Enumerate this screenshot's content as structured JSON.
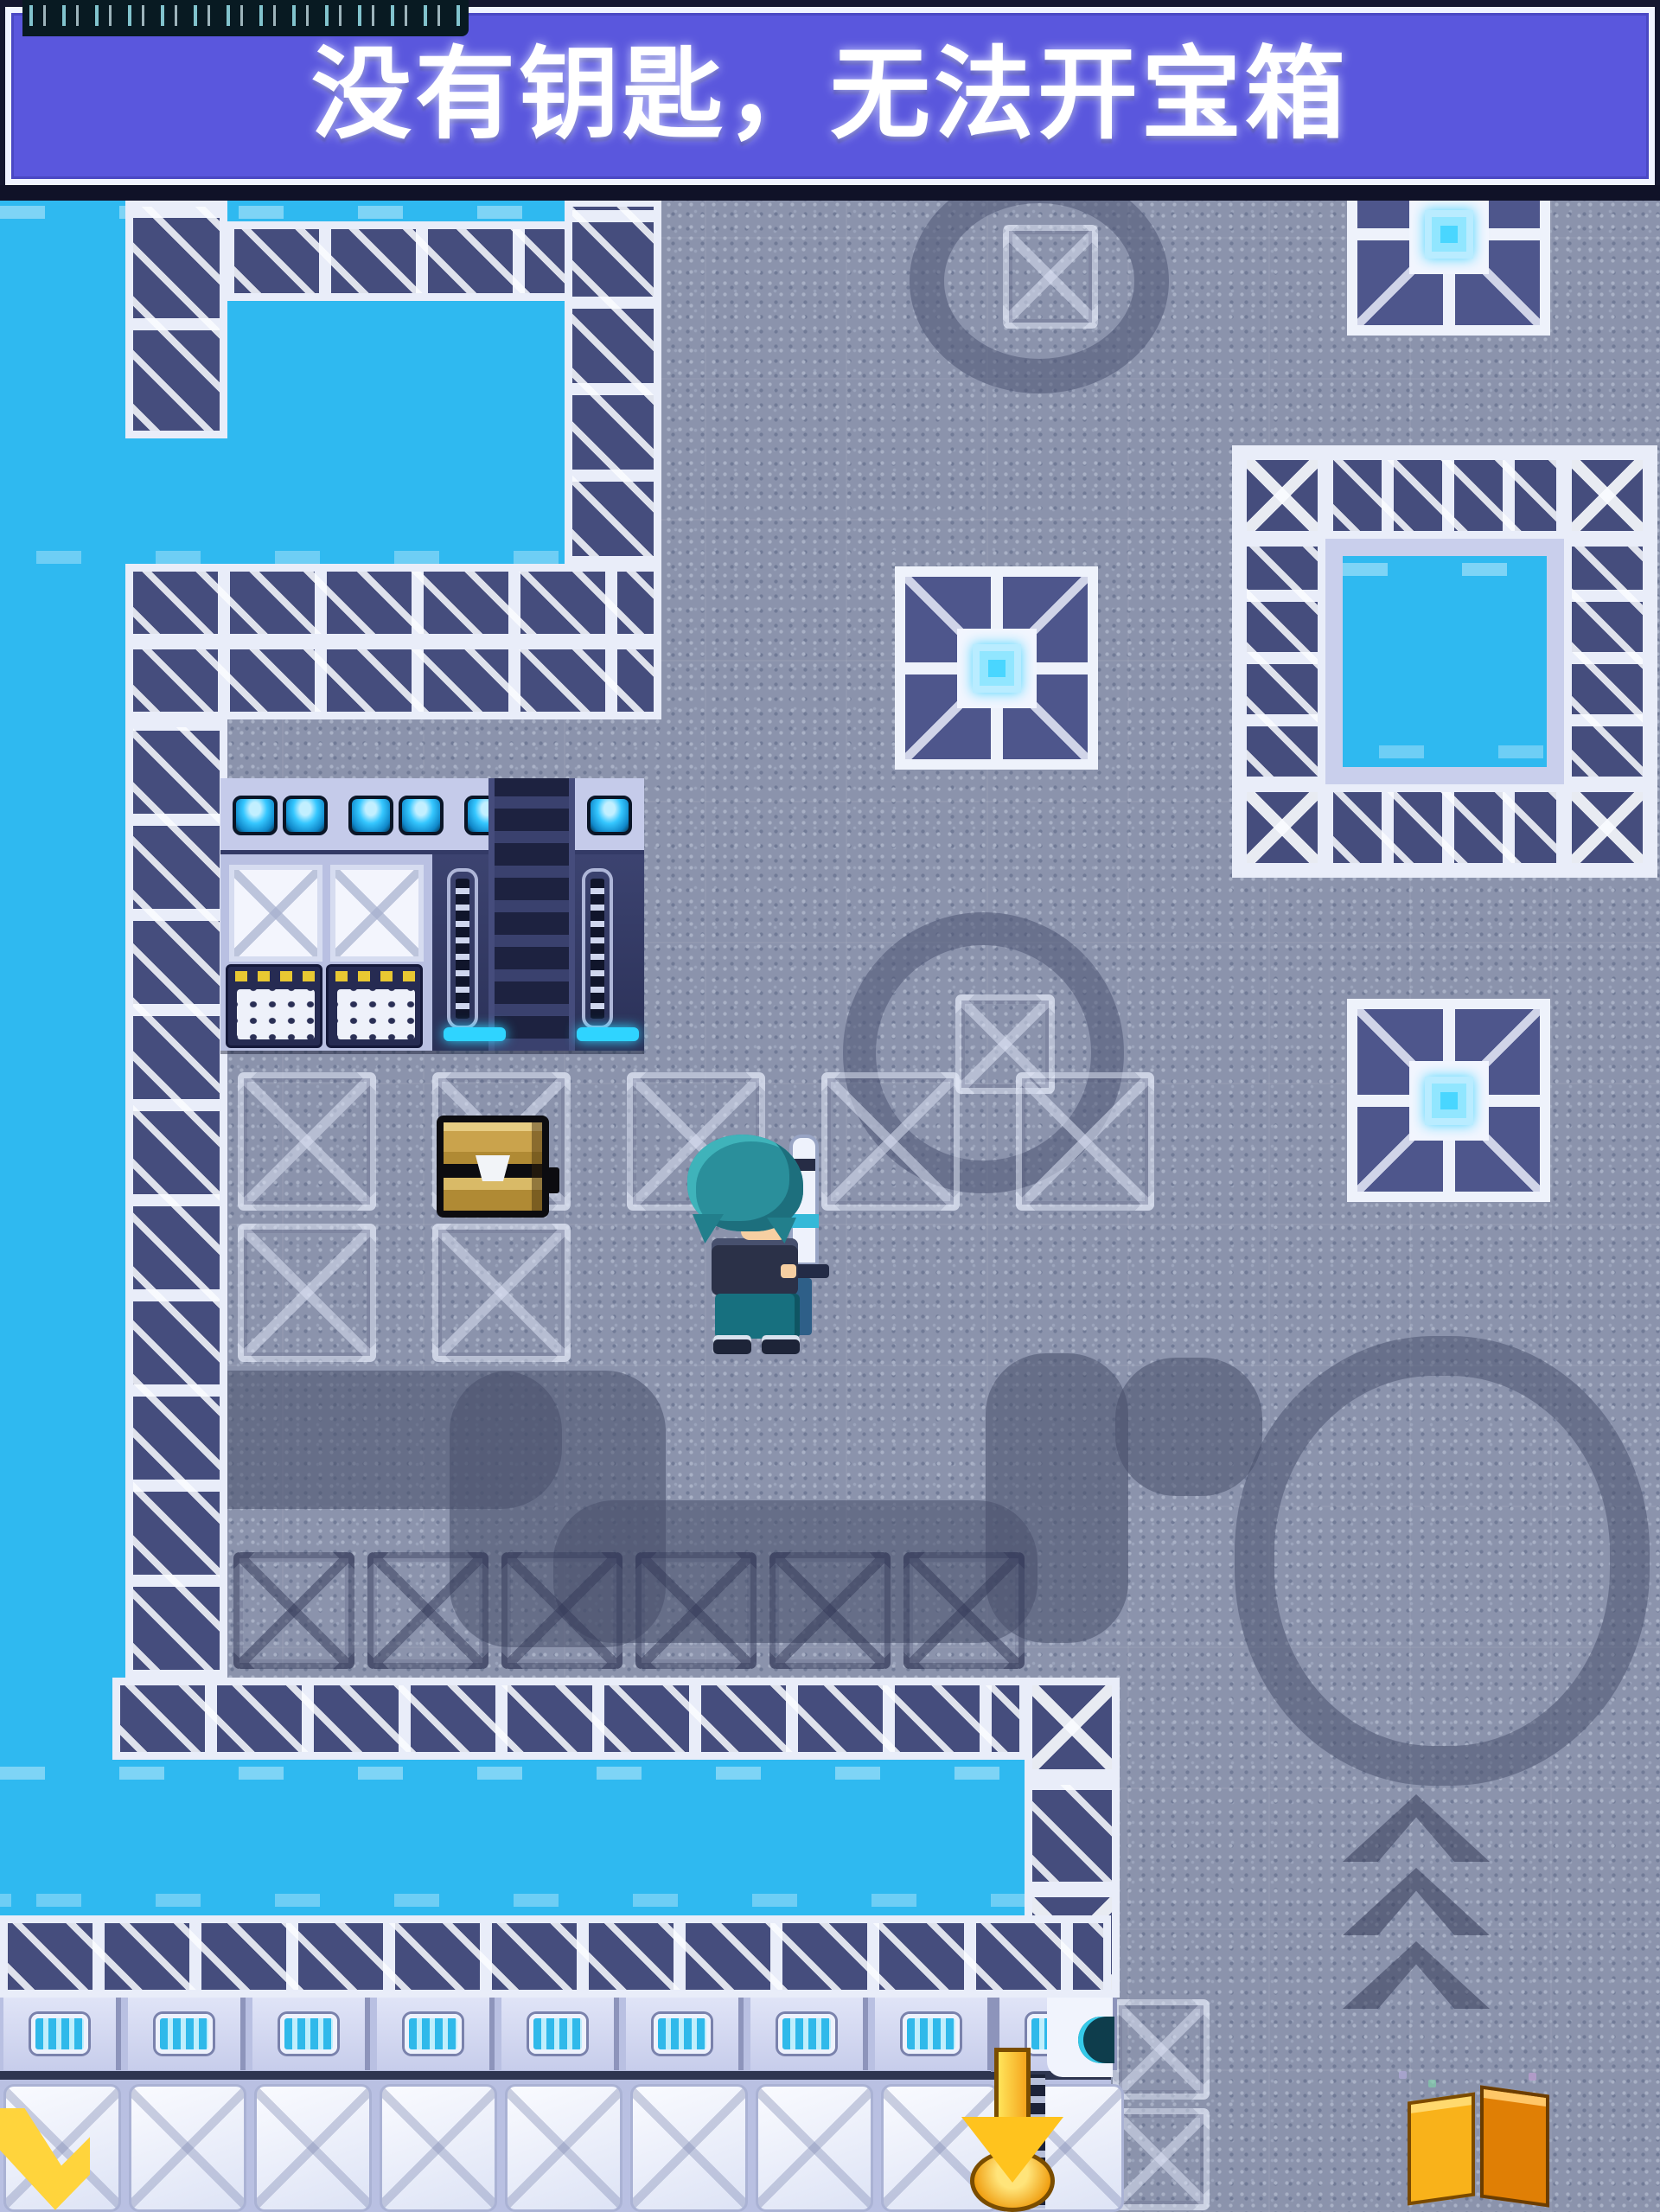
{
  "banner": {
    "text": "没有钥匙，无法开宝箱",
    "bg_color": "#5a57dd",
    "text_color": "#ffffff"
  },
  "status_bar": {
    "description": "system-tick-marks"
  },
  "map": {
    "colors": {
      "floor": "#8b93ac",
      "water": "#2fb9f0",
      "tile_frame": "#e9edf9",
      "tile_dark": "#454d7d",
      "gem": "#49d6ff",
      "marker_yellow": "#ffc31e"
    },
    "entities": {
      "player": "hero-sprite",
      "treasure_chest": "closed-wooden-chest",
      "goal_marker": "yellow-down-arrow",
      "corner_marker": "yellow-chevron",
      "loot_item": "orange-open-box",
      "machine": "control-console",
      "emblems": [
        "gem-emblem-top-right",
        "gem-emblem-center",
        "gem-emblem-right"
      ]
    }
  }
}
